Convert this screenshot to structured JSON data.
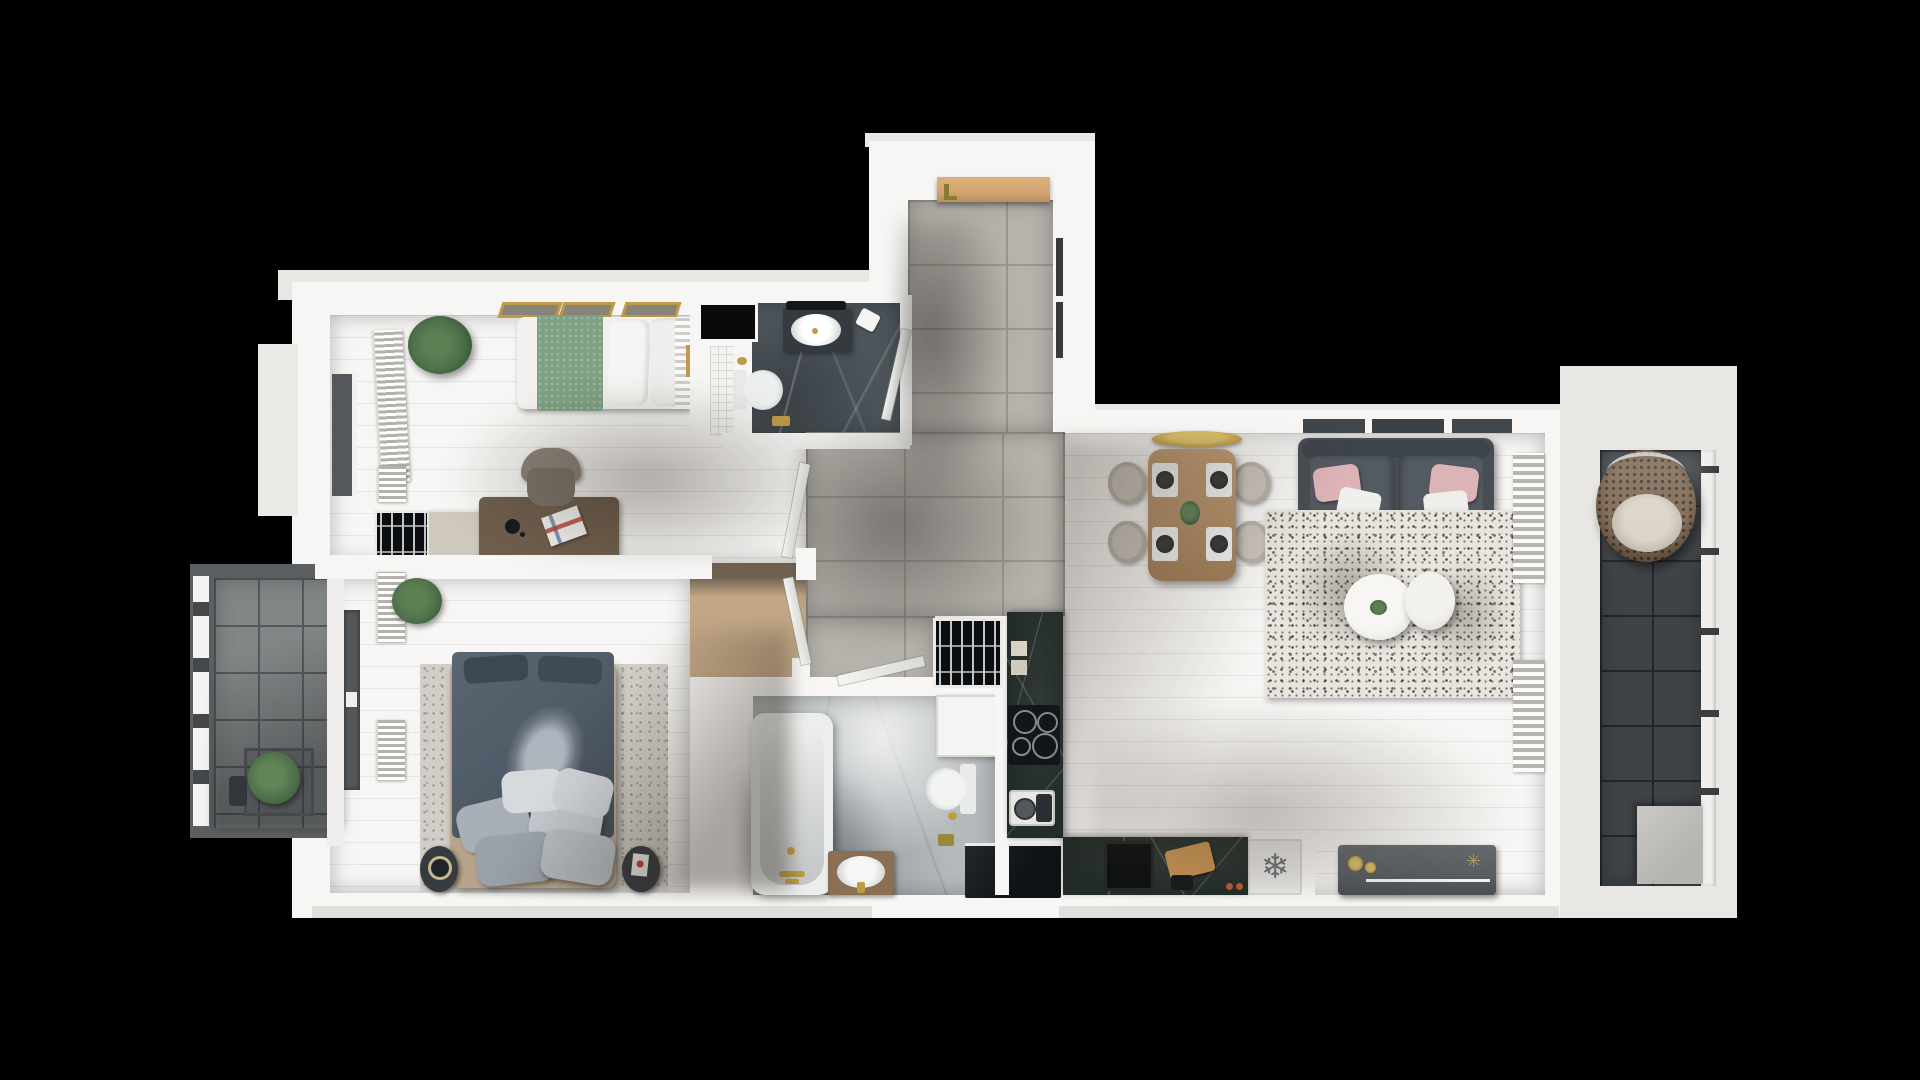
{
  "scene": {
    "description": "3D top-down rendered floor plan of a two-bedroom apartment with two balconies, shown on a black background",
    "background": "#000000"
  },
  "icons": {
    "snowflake": {
      "name": "snowflake-icon",
      "glyph": "❄"
    },
    "plant_star": {
      "name": "plant-star-icon",
      "glyph": "✳"
    }
  },
  "palette": {
    "bg": "#000000",
    "wall": "#f7f6f4",
    "wallShade": "#e8e7e4",
    "outerBand": "#dfdedb",
    "woodDark": "#8b7866",
    "woodLight": "#c6aa88",
    "woodLiving": "#c2a27c",
    "tile": "#b6b2ac",
    "grout": "#9b9790",
    "marbleDark": "#4d555b",
    "marbleLight": "#b4b9bb",
    "counterDark": "#232c29",
    "balconyDarkTile": "#3e4347",
    "balconyLightTile": "#838687",
    "rugLiving": "#e8e5df",
    "rugMaster": "#d0cec7",
    "sofaGray": "#474d54",
    "cushionGray": "#545a61",
    "pillowPink": "#dcb3b7",
    "plantGreen": "#51734c",
    "plantGreenDark": "#3a5a3a",
    "gold": "#bf9b45",
    "duvetBlue": "#515c69",
    "blanketGreen": "#7fa184",
    "chairGray": "#c9c3bb",
    "fridgeWhite": "#e9e8e6",
    "doorWood": "#d2a670",
    "glassDark": "#55585a",
    "applianceBlack": "#131619",
    "benchGray": "#5a5f63"
  },
  "rooms": [
    {
      "id": "bedroom-1",
      "label": "Bedroom",
      "furniture": [
        "single-bed-green",
        "desk",
        "office-chair",
        "desk-lamp",
        "magazine",
        "wardrobe-cabinet",
        "bottle-rack",
        "potted-plant",
        "radiator",
        "window-x3"
      ]
    },
    {
      "id": "master-bedroom",
      "label": "Master Bedroom",
      "furniture": [
        "double-bed",
        "pillow-pile",
        "area-rug",
        "bedside-table-x2",
        "potted-plant",
        "radiator-x2",
        "balcony-glass-door"
      ]
    },
    {
      "id": "bathroom-top",
      "label": "Bathroom",
      "furniture": [
        "washbasin-vanity",
        "toilet",
        "shower-niche",
        "gold-towel-rail"
      ]
    },
    {
      "id": "bathroom-bottom",
      "label": "Bathroom with Bathtub",
      "furniture": [
        "bathtub",
        "washbasin-vanity",
        "toilet",
        "washing-machine",
        "dark-cabinet"
      ]
    },
    {
      "id": "entrance-hall",
      "label": "Entrance Hall",
      "furniture": [
        "entrance-door",
        "built-in-wardrobe-niches",
        "floor-tiles"
      ]
    },
    {
      "id": "living-room",
      "label": "Living Room",
      "furniture": [
        "sofa-with-pink-pillows",
        "terrazzo-rug",
        "round-coffee-table-x2",
        "tv-bench",
        "radiator-x2",
        "window-band"
      ]
    },
    {
      "id": "dining-area",
      "label": "Dining Area",
      "furniture": [
        "wood-dining-table",
        "chair-x4",
        "place-setting-x4",
        "gold-pendant-lamp",
        "table-plant"
      ]
    },
    {
      "id": "kitchen",
      "label": "Kitchen",
      "furniture": [
        "wine-rack",
        "counter-column",
        "induction-cooktop",
        "coffee-machine",
        "bottom-counter",
        "sink",
        "cutting-board",
        "fridge-with-snowflake"
      ]
    },
    {
      "id": "balcony-left",
      "label": "Balcony",
      "furniture": [
        "planter-box",
        "watering-can",
        "glass-railing"
      ]
    },
    {
      "id": "balcony-right",
      "label": "Loggia",
      "furniture": [
        "hanging-egg-chair",
        "railing",
        "step-box"
      ]
    }
  ]
}
